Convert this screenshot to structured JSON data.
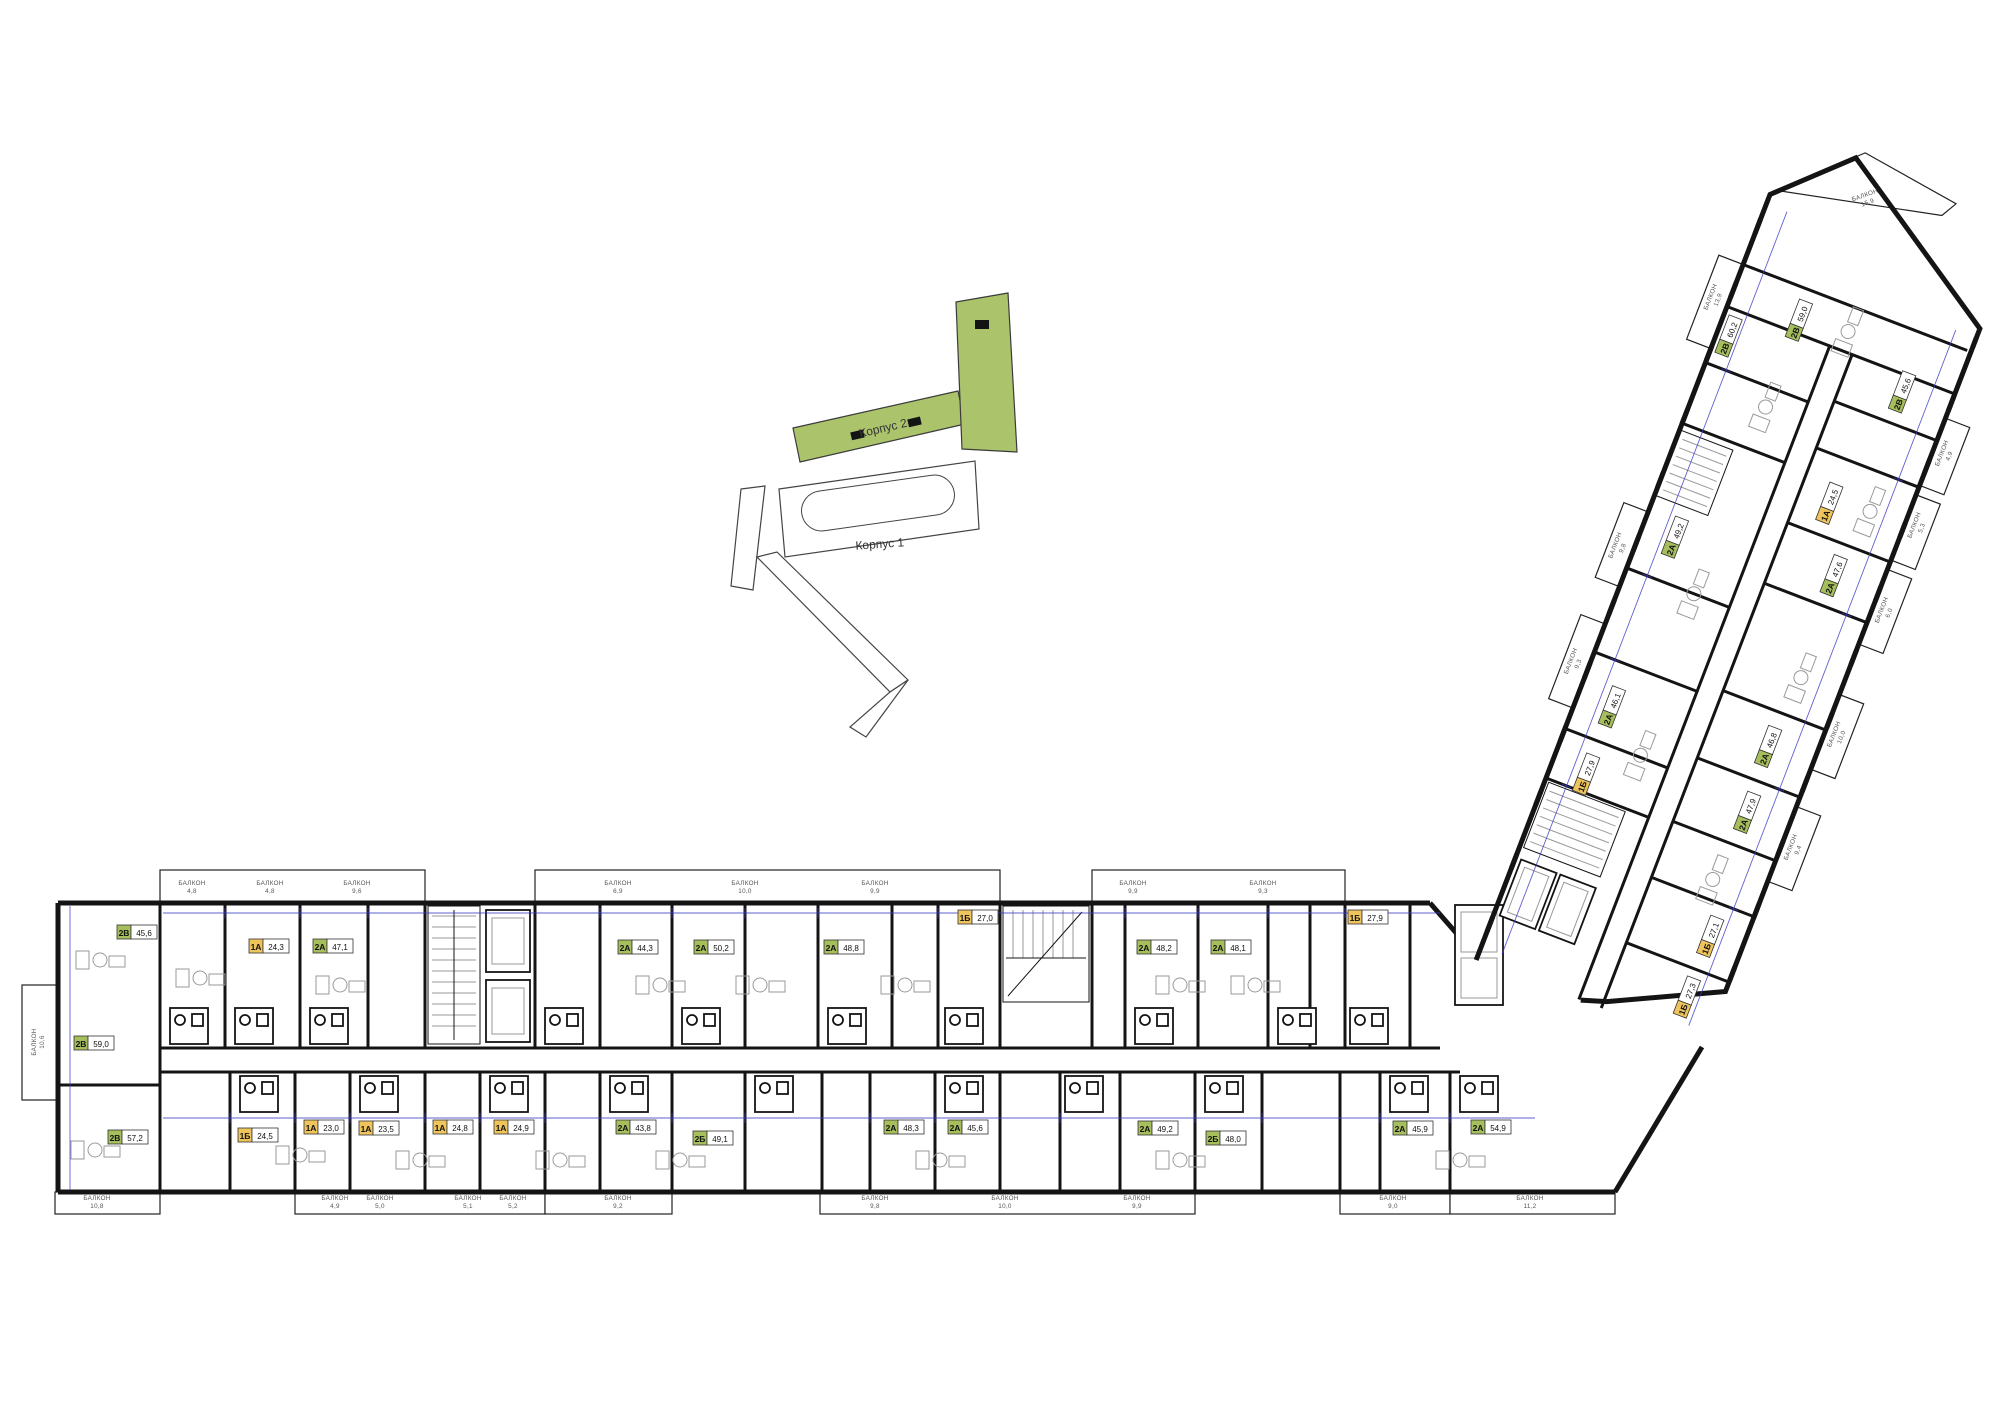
{
  "site_map": {
    "building2_label": "Корпус 2",
    "building1_label": "Корпус 1",
    "highlight_color": "#abc46c"
  },
  "plan": {
    "balcony_word": "БАЛКОН",
    "unit_type_colors": {
      "1А": "#efc45c",
      "1Б": "#efc45c",
      "2А": "#a6bf5c",
      "2Б": "#a6bf5c",
      "2В": "#a6bf5c"
    },
    "units": [
      {
        "t": "2В",
        "a": "45,6"
      },
      {
        "t": "1А",
        "a": "24,3"
      },
      {
        "t": "2А",
        "a": "47,1"
      },
      {
        "t": "2А",
        "a": "44,3"
      },
      {
        "t": "2А",
        "a": "50,2"
      },
      {
        "t": "2А",
        "a": "48,8"
      },
      {
        "t": "1Б",
        "a": "27,0"
      },
      {
        "t": "2А",
        "a": "48,2"
      },
      {
        "t": "2А",
        "a": "48,1"
      },
      {
        "t": "1Б",
        "a": "27,9"
      },
      {
        "t": "2В",
        "a": "59,0"
      },
      {
        "t": "2В",
        "a": "57,2"
      },
      {
        "t": "1Б",
        "a": "24,5"
      },
      {
        "t": "1А",
        "a": "23,0"
      },
      {
        "t": "1А",
        "a": "23,5"
      },
      {
        "t": "1А",
        "a": "24,8"
      },
      {
        "t": "1А",
        "a": "24,9"
      },
      {
        "t": "2А",
        "a": "43,8"
      },
      {
        "t": "2Б",
        "a": "49,1"
      },
      {
        "t": "2А",
        "a": "48,3"
      },
      {
        "t": "2А",
        "a": "45,6"
      },
      {
        "t": "2А",
        "a": "49,2"
      },
      {
        "t": "2Б",
        "a": "48,0"
      },
      {
        "t": "2А",
        "a": "45,9"
      },
      {
        "t": "2А",
        "a": "54,9"
      },
      {
        "t": "1Б",
        "a": "27,3"
      },
      {
        "t": "1Б",
        "a": "27,1"
      },
      {
        "t": "2А",
        "a": "47,9"
      },
      {
        "t": "2А",
        "a": "46,8"
      },
      {
        "t": "2А",
        "a": "47,6"
      },
      {
        "t": "1А",
        "a": "24,5"
      },
      {
        "t": "2В",
        "a": "45,6"
      },
      {
        "t": "1Б",
        "a": "27,9"
      },
      {
        "t": "2А",
        "a": "46,1"
      },
      {
        "t": "2А",
        "a": "49,2"
      },
      {
        "t": "2В",
        "a": "59,0"
      },
      {
        "t": "2В",
        "a": "60,2"
      }
    ],
    "balconies": [
      "4,8",
      "4,8",
      "9,6",
      "6,9",
      "10,0",
      "9,9",
      "9,9",
      "9,3",
      "10,6",
      "10,8",
      "4,9",
      "5,0",
      "5,1",
      "5,2",
      "9,2",
      "9,8",
      "10,0",
      "9,9",
      "9,0",
      "11,2",
      "9,3",
      "9,8",
      "13,9",
      "9,4",
      "10,0",
      "6,0",
      "5,3",
      "4,9",
      "15,9"
    ]
  }
}
